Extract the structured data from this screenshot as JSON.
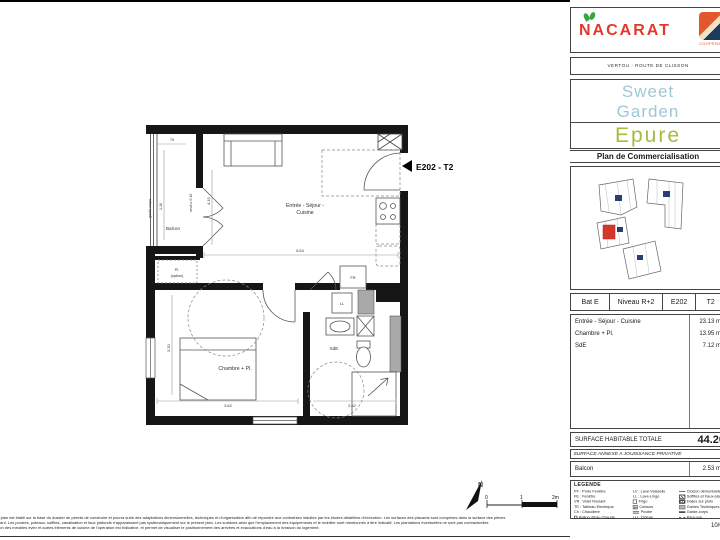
{
  "header": {
    "brand": "NACARAT",
    "coop_label": "COOPÉRA",
    "location": "VERTOU - ROUTE DE CLISSON",
    "project_line1": "Sweet",
    "project_line2": "Garden",
    "project_line3": "Epure",
    "doc_title": "Plan de Commercialisation"
  },
  "info_table": {
    "bat": "Bat E",
    "niveau": "Niveau R+2",
    "lot": "E202",
    "type": "T2"
  },
  "surfaces": {
    "rows": [
      {
        "label": "Entrée - Séjour - Cuisine",
        "value": "23.13 m²"
      },
      {
        "label": "Chambre + Pl.",
        "value": "13.95 m²"
      },
      {
        "label": "SdE",
        "value": "7.12 m²"
      }
    ],
    "total_label": "SURFACE HABITABLE TOTALE",
    "total_value": "44.20",
    "annex_header": "SURFACE ANNEXE A JOUISSANCE PRIVATIVE",
    "annex_rows": [
      {
        "label": "Balcon",
        "value": "2.53 m²"
      }
    ]
  },
  "plan": {
    "marker": "E202 - T2",
    "rooms": {
      "living1": "Entrée - Séjour -",
      "living2": "Cuisine",
      "bedroom": "Chambre + Pl.",
      "bathroom": "SdE",
      "balcony": "Balcon",
      "closet1": "Pl.",
      "closet2": "(option)",
      "fridge": "FR",
      "washer": "LL"
    },
    "labels": {
      "railing": "garde-corps",
      "threshold": "seuil ≤ 0.10"
    },
    "dims": {
      "living_w": "5.64",
      "living_h": "4.15",
      "bedroom_w": "3.62",
      "bedroom_h": "3.20",
      "bathroom_w": "2.62",
      "balcony_d": "1.16",
      "balcony_w": "75"
    },
    "scale": {
      "north": "N",
      "t0": "0",
      "t1": "1",
      "t2": "2m"
    }
  },
  "legend": {
    "title": "LEGENDE",
    "col1": [
      "PF : Porte Fenêtre",
      "FE : Fenêtre",
      "VR : Volet Roulant",
      "TE : Tableau Electrique",
      "Ch : Chaudière",
      "Ballon d'Eau Chaude"
    ],
    "col2": [
      "LV : Lave-Vaisselle",
      "LL : Lave-Linge",
      "Frigo",
      "Cuisson",
      "Poutre",
      "Clôture"
    ],
    "col3": [
      "Cloison démontable",
      "Soffites et Faux-plafonds",
      "Dalles sur plots",
      "Gaines Techniques",
      "Garde-corps",
      "Pare-vue"
    ]
  },
  "footer": {
    "date": "10/04",
    "disclaimer": [
      "ent plan est établi sur la base du dossier de permis de construire et pourra subir des adaptations dimensionnelles, techniques et d'organisation afin de répondre aux contraintes induites par les études détaillées d'exécution. Les surfaces des placards sont comprises dans la surface des pièces",
      "situant. Les poutres, poteaux, soffites, canalisation et faux plafonds n'apparaissent pas systématiquement sur le présent plan. Les surfaces ainsi que l'emplacement des équipements et le mobilier sont mentionnés à titre indicatif. Les plantations éventuelles ne sont pas contractuelles",
      "tation des meubles évier et autres éléments de cuisine de l'opération est indicative, et permet de visualiser le positionnement des arrivées et évacuations d'eau à la livraison du logement."
    ]
  }
}
